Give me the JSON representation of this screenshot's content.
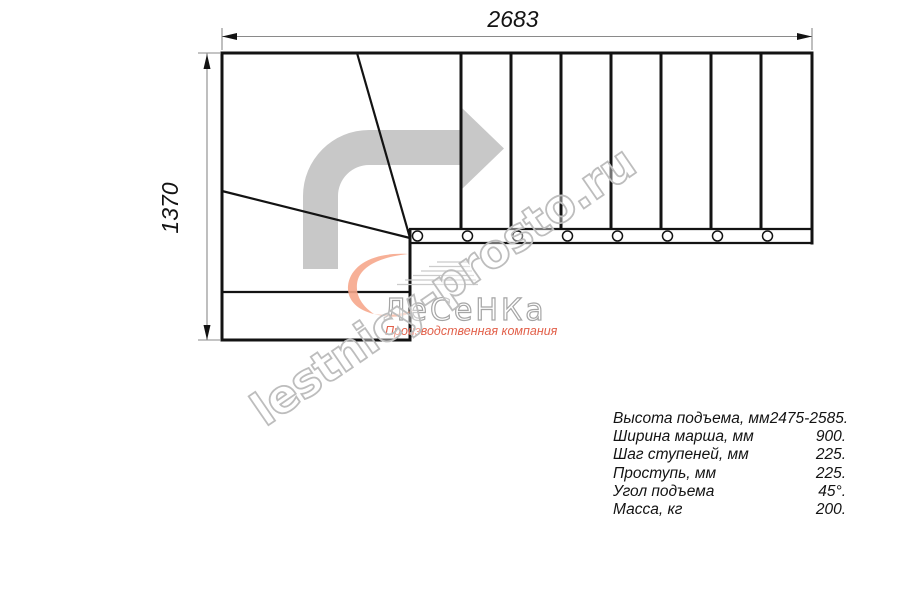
{
  "drawing": {
    "title_hint": "L-shaped staircase plan view",
    "dimension_width": "2683",
    "dimension_height": "1370"
  },
  "watermark": {
    "text": "lestnicy-prosto.ru"
  },
  "logo": {
    "wordmark": "ЛеСеНКа",
    "tagline": "Производственная компания"
  },
  "specs": {
    "rows": [
      {
        "label": "Высота подъема, мм",
        "value": "2475-2585."
      },
      {
        "label": "Ширина марша, мм",
        "value": "900."
      },
      {
        "label": "Шаг ступеней, мм",
        "value": "225."
      },
      {
        "label": "Проступь, мм",
        "value": "225."
      },
      {
        "label": "Угол подъема",
        "value": "45°."
      },
      {
        "label": "Масса, кг",
        "value": "200."
      }
    ]
  },
  "icons": {
    "direction_arrow": "turn-right-arrow-icon",
    "balusters": "baluster-circle-icon",
    "logo_swoosh": "logo-swoosh-icon"
  },
  "colors": {
    "line": "#131313",
    "dimension_line": "#8a8a8a",
    "direction_arrow": "#c8c8c8",
    "watermark_outline": "#bdbdbd",
    "logo_accent": "#f6a78c",
    "logo_tagline": "#e2604a"
  }
}
